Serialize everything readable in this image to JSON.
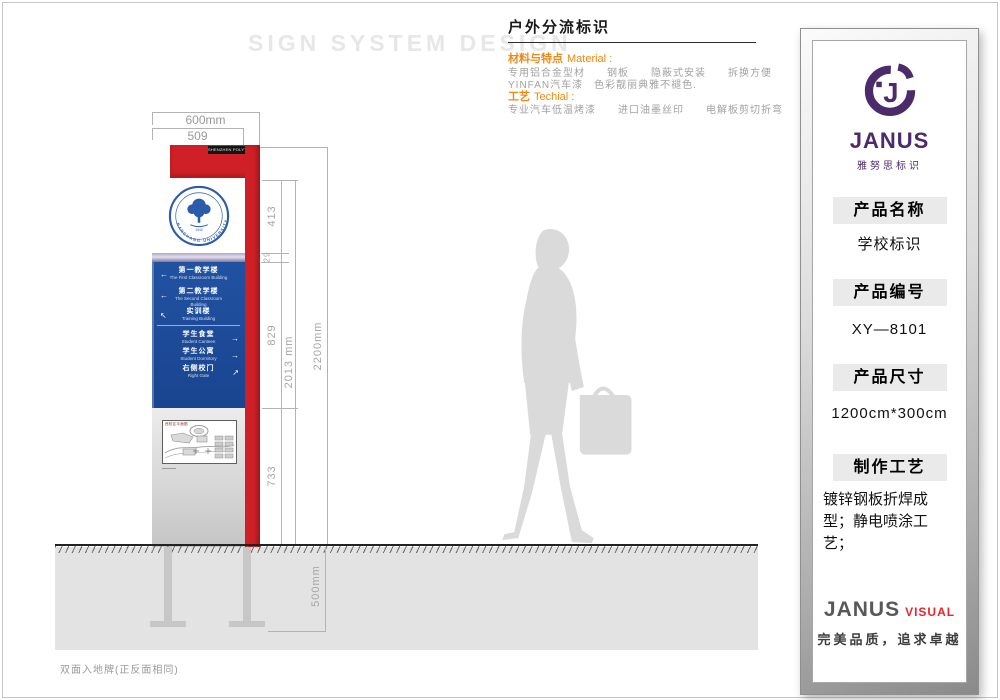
{
  "page": {
    "watermark": "SIGN SYSTEM DESIGN",
    "bottom_note": "双面入地牌(正反面相同)"
  },
  "header": {
    "title": "户外分流标识",
    "material_label_cn": "材料与特点",
    "material_label_en": "Material :",
    "material_line1": "专用铝合金型材　　钢板　　隐蔽式安装　　拆换方便",
    "material_line2": "YINFAN汽车漆　色彩靓丽典雅不褪色.",
    "tech_label_cn": "工艺",
    "tech_label_en": "Techial :",
    "tech_line1": "专业汽车低温烤漆　　进口油墨丝印　　电解板剪切折弯"
  },
  "sign": {
    "top_strip": "SHENZHEN POLYTECHNIC",
    "logo": {
      "university_en": "NANCHANG UNIVERSITY",
      "year": "1940"
    },
    "directory": {
      "items": [
        {
          "cn": "第一教学楼",
          "en": "The First Classroom Building",
          "arrow": "←"
        },
        {
          "cn": "第二教学楼",
          "en": "The Second Classroom Building",
          "arrow": "←"
        },
        {
          "cn": "实训楼",
          "en": "Training Building",
          "arrow": "↖"
        },
        {
          "cn": "学生食堂",
          "en": "Student Canteen",
          "arrow": "→"
        },
        {
          "cn": "学生公寓",
          "en": "Student Dormitory",
          "arrow": "→"
        },
        {
          "cn": "右侧校门",
          "en": "Right Gate",
          "arrow": "↗"
        }
      ]
    },
    "map_title": "西校区平面图"
  },
  "dimensions": {
    "width_total": "600mm",
    "width_panel": "509",
    "h_logo": "413",
    "h_divider": "29",
    "h_directory": "829",
    "h_map": "733",
    "h_panel": "2013 mm",
    "h_total": "2200mm",
    "depth_underground": "500mm"
  },
  "info_panel": {
    "brand": {
      "name": "JANUS",
      "cn": "雅努思标识"
    },
    "sections": [
      {
        "label": "产品名称",
        "value": "学校标识"
      },
      {
        "label": "产品编号",
        "value": "XY—8101"
      },
      {
        "label": "产品尺寸",
        "value": "1200cm*300cm"
      },
      {
        "label": "制作工艺",
        "value": "镀锌钢板折焊成型；静电喷涂工艺；"
      }
    ],
    "footer": {
      "brand": "JANUS",
      "suffix": "VISUAL",
      "tagline": "完美品质，追求卓越"
    }
  },
  "colors": {
    "red": "#ce2026",
    "blue": "#1e4d9d",
    "purple": "#4b2b6b",
    "orange": "#ef8913",
    "accent_red": "#e5262c"
  }
}
